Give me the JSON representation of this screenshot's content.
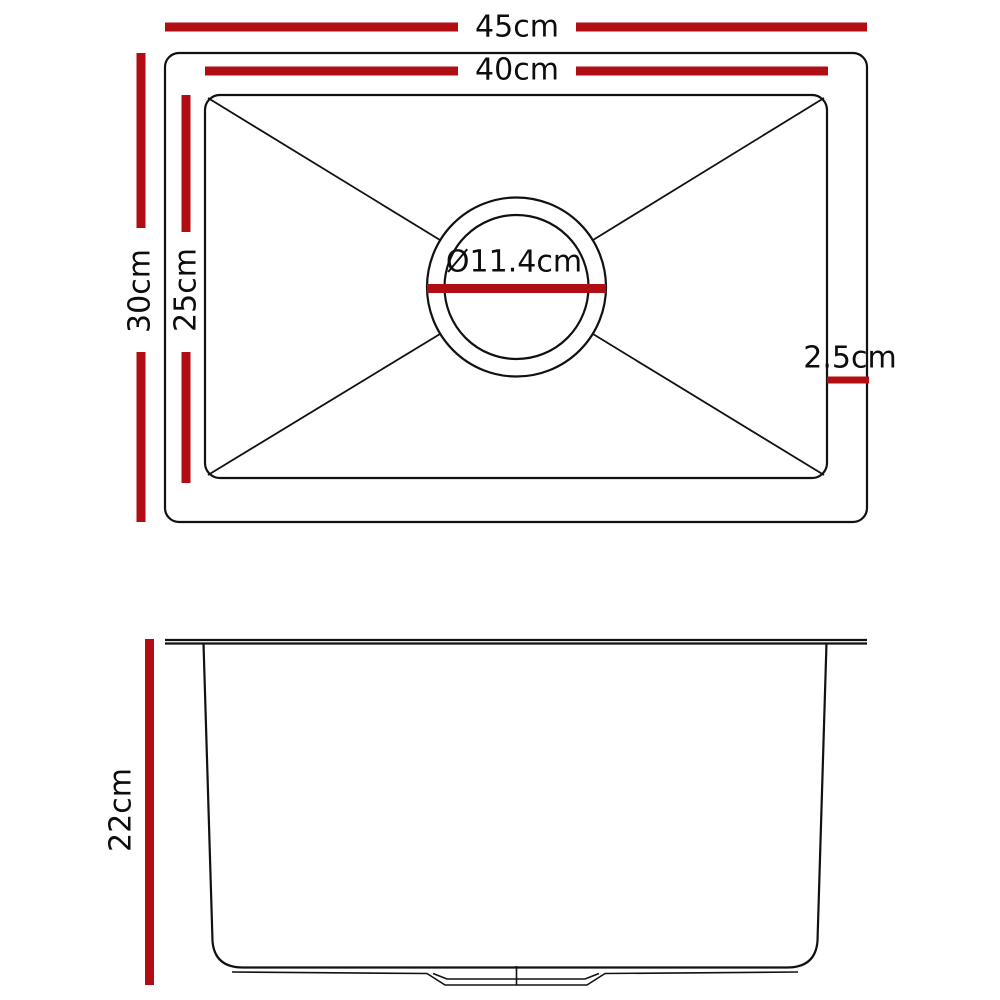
{
  "colors": {
    "dimension_red": "#b10e13",
    "line_black": "#111111",
    "background": "#ffffff"
  },
  "top_view": {
    "outer_width_label": "45cm",
    "inner_width_label": "40cm",
    "outer_depth_label": "30cm",
    "inner_depth_label": "25cm",
    "drain_diameter_label": "Ø11.4cm",
    "rim_offset_label": "2.5cm"
  },
  "side_view": {
    "height_label": "22cm"
  }
}
